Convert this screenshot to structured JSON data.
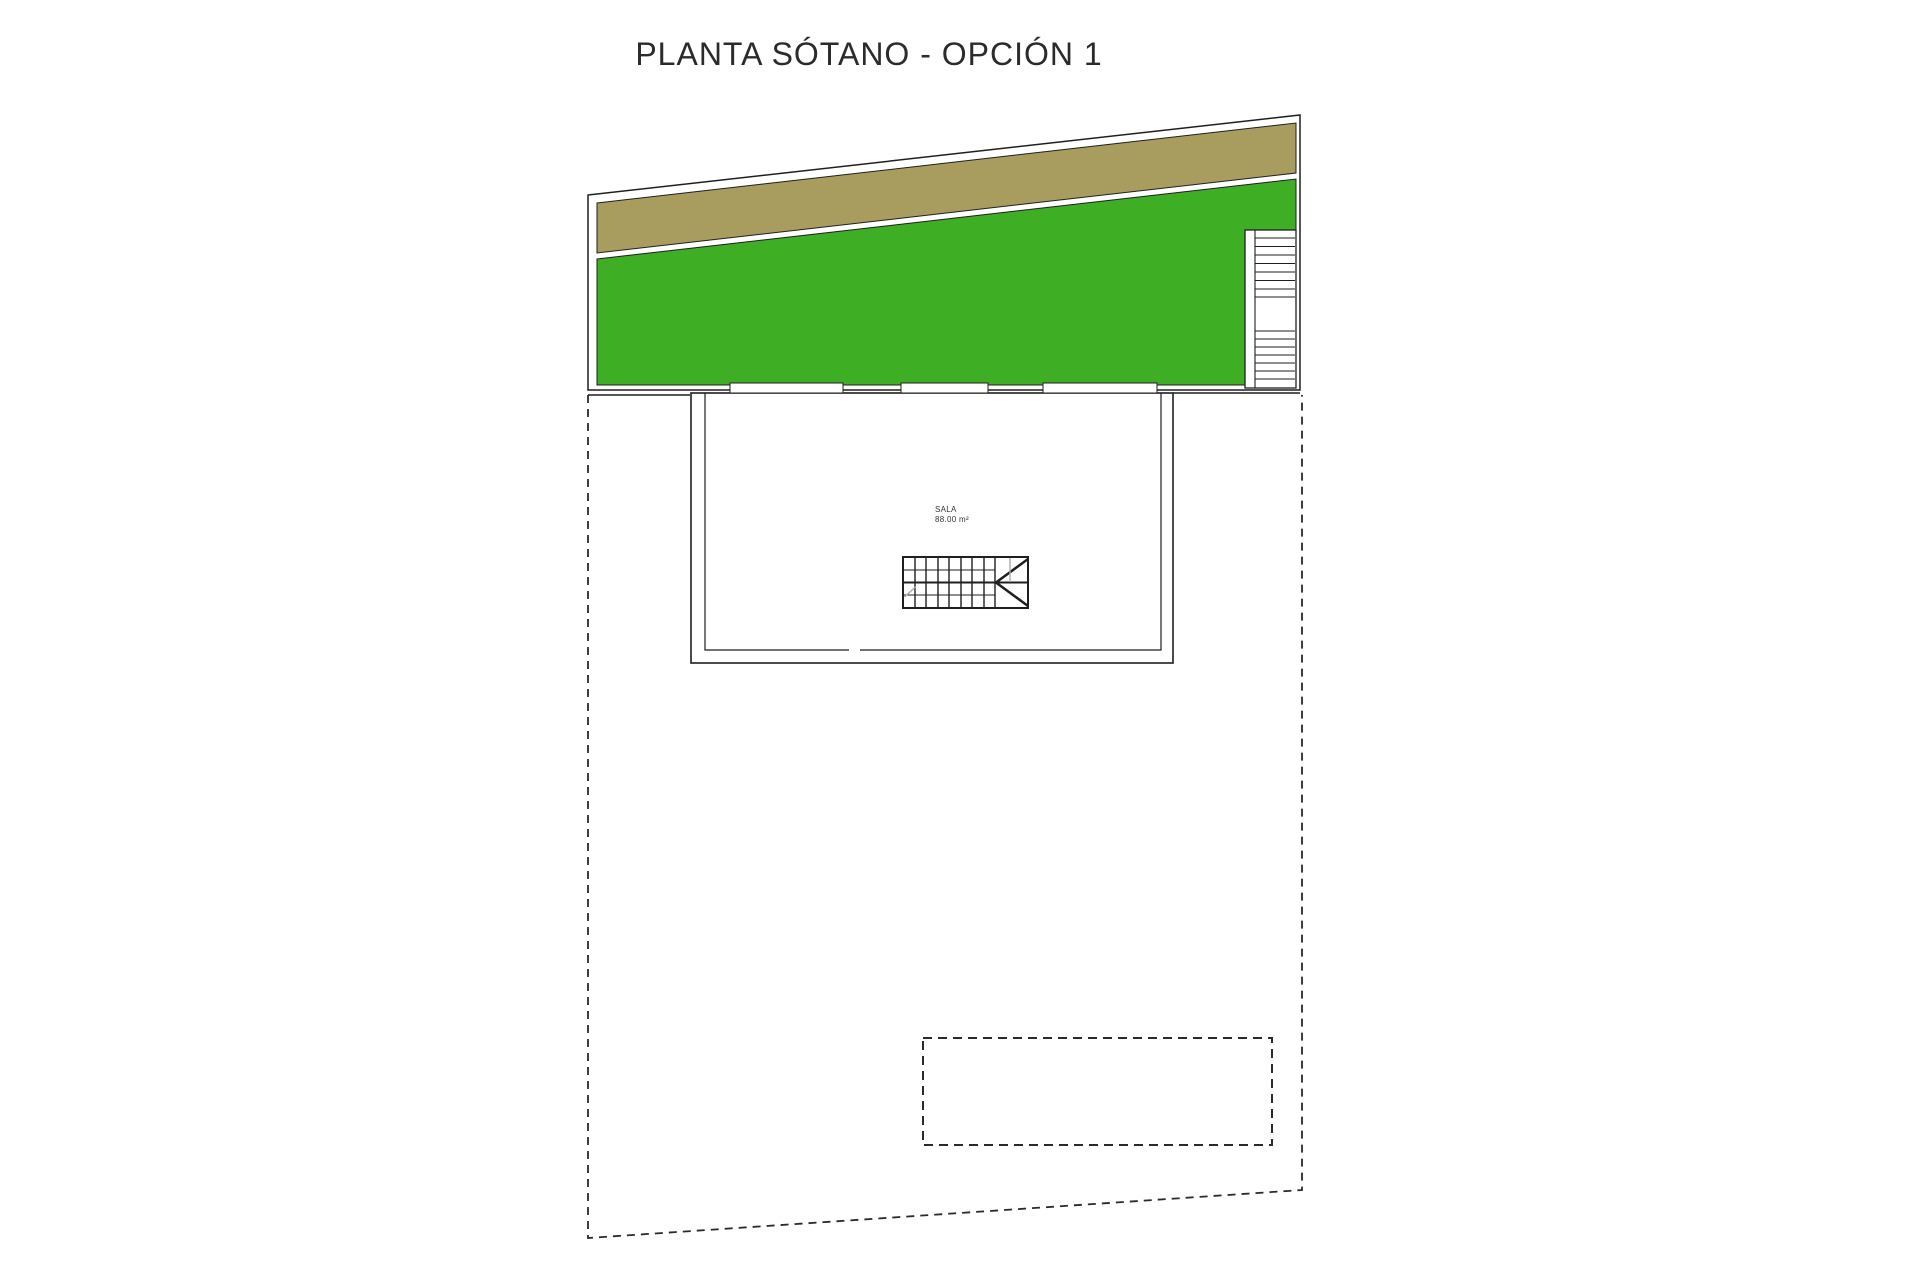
{
  "title": "PLANTA SÓTANO - OPCIÓN 1",
  "plan": {
    "room_sala": {
      "label": "SALA",
      "area": "88.00 m²"
    }
  },
  "colors": {
    "grass": "#3EAE24",
    "soil": "#A89C5F"
  }
}
